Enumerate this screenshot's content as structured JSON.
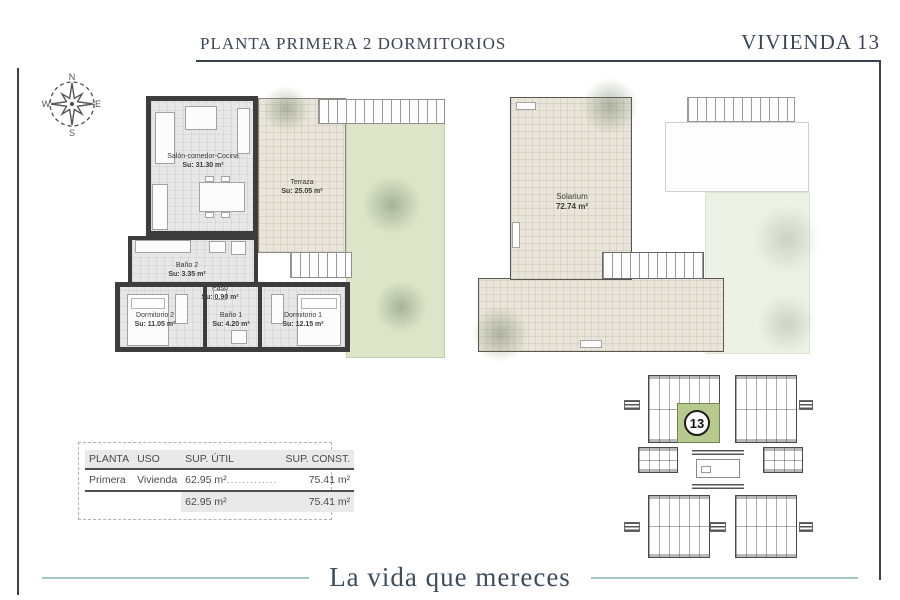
{
  "header": {
    "left_title": "PLANTA PRIMERA  2 DORMITORIOS",
    "right_title": "VIVIENDA 13"
  },
  "compass": {
    "north": "N",
    "east": "E",
    "south": "S",
    "west": "W"
  },
  "floor_plan": {
    "rooms": [
      {
        "name": "Salón-comedor-Cocina",
        "area": "Su: 31.30 m²"
      },
      {
        "name": "Terraza",
        "area": "Su: 25.05 m²"
      },
      {
        "name": "Baño 2",
        "area": "Su: 3.35 m²"
      },
      {
        "name": "Paso",
        "area": "Su: 0.90 m²"
      },
      {
        "name": "Dormitorio 2",
        "area": "Su: 11.05 m²"
      },
      {
        "name": "Baño 1",
        "area": "Su: 4.20 m²"
      },
      {
        "name": "Dormitorio 1",
        "area": "Su: 12.15 m²"
      }
    ]
  },
  "solarium_plan": {
    "room": {
      "name": "Solarium",
      "area": "72.74 m²"
    }
  },
  "site_plan": {
    "highlighted_unit": "13"
  },
  "areas_table": {
    "headers": [
      "PLANTA",
      "USO",
      "SUP. ÚTIL",
      "SUP. CONST."
    ],
    "row": {
      "planta": "Primera",
      "uso": "Vivienda",
      "sup_util": "62.95 m²",
      "leader": ".............",
      "sup_const": "75.41 m²"
    },
    "totals": {
      "sup_util": "62.95 m²",
      "sup_const": "75.41 m²"
    }
  },
  "footer": {
    "tagline": "La vida que mereces"
  },
  "colors": {
    "accent_navy": "#3a4657",
    "accent_teal": "#a3c8c8",
    "highlight_green": "#b7ca8e",
    "terrace_beige": "#e9e5da",
    "garden_green": "#dce5c8",
    "wall_dark": "#3d3d3d"
  }
}
